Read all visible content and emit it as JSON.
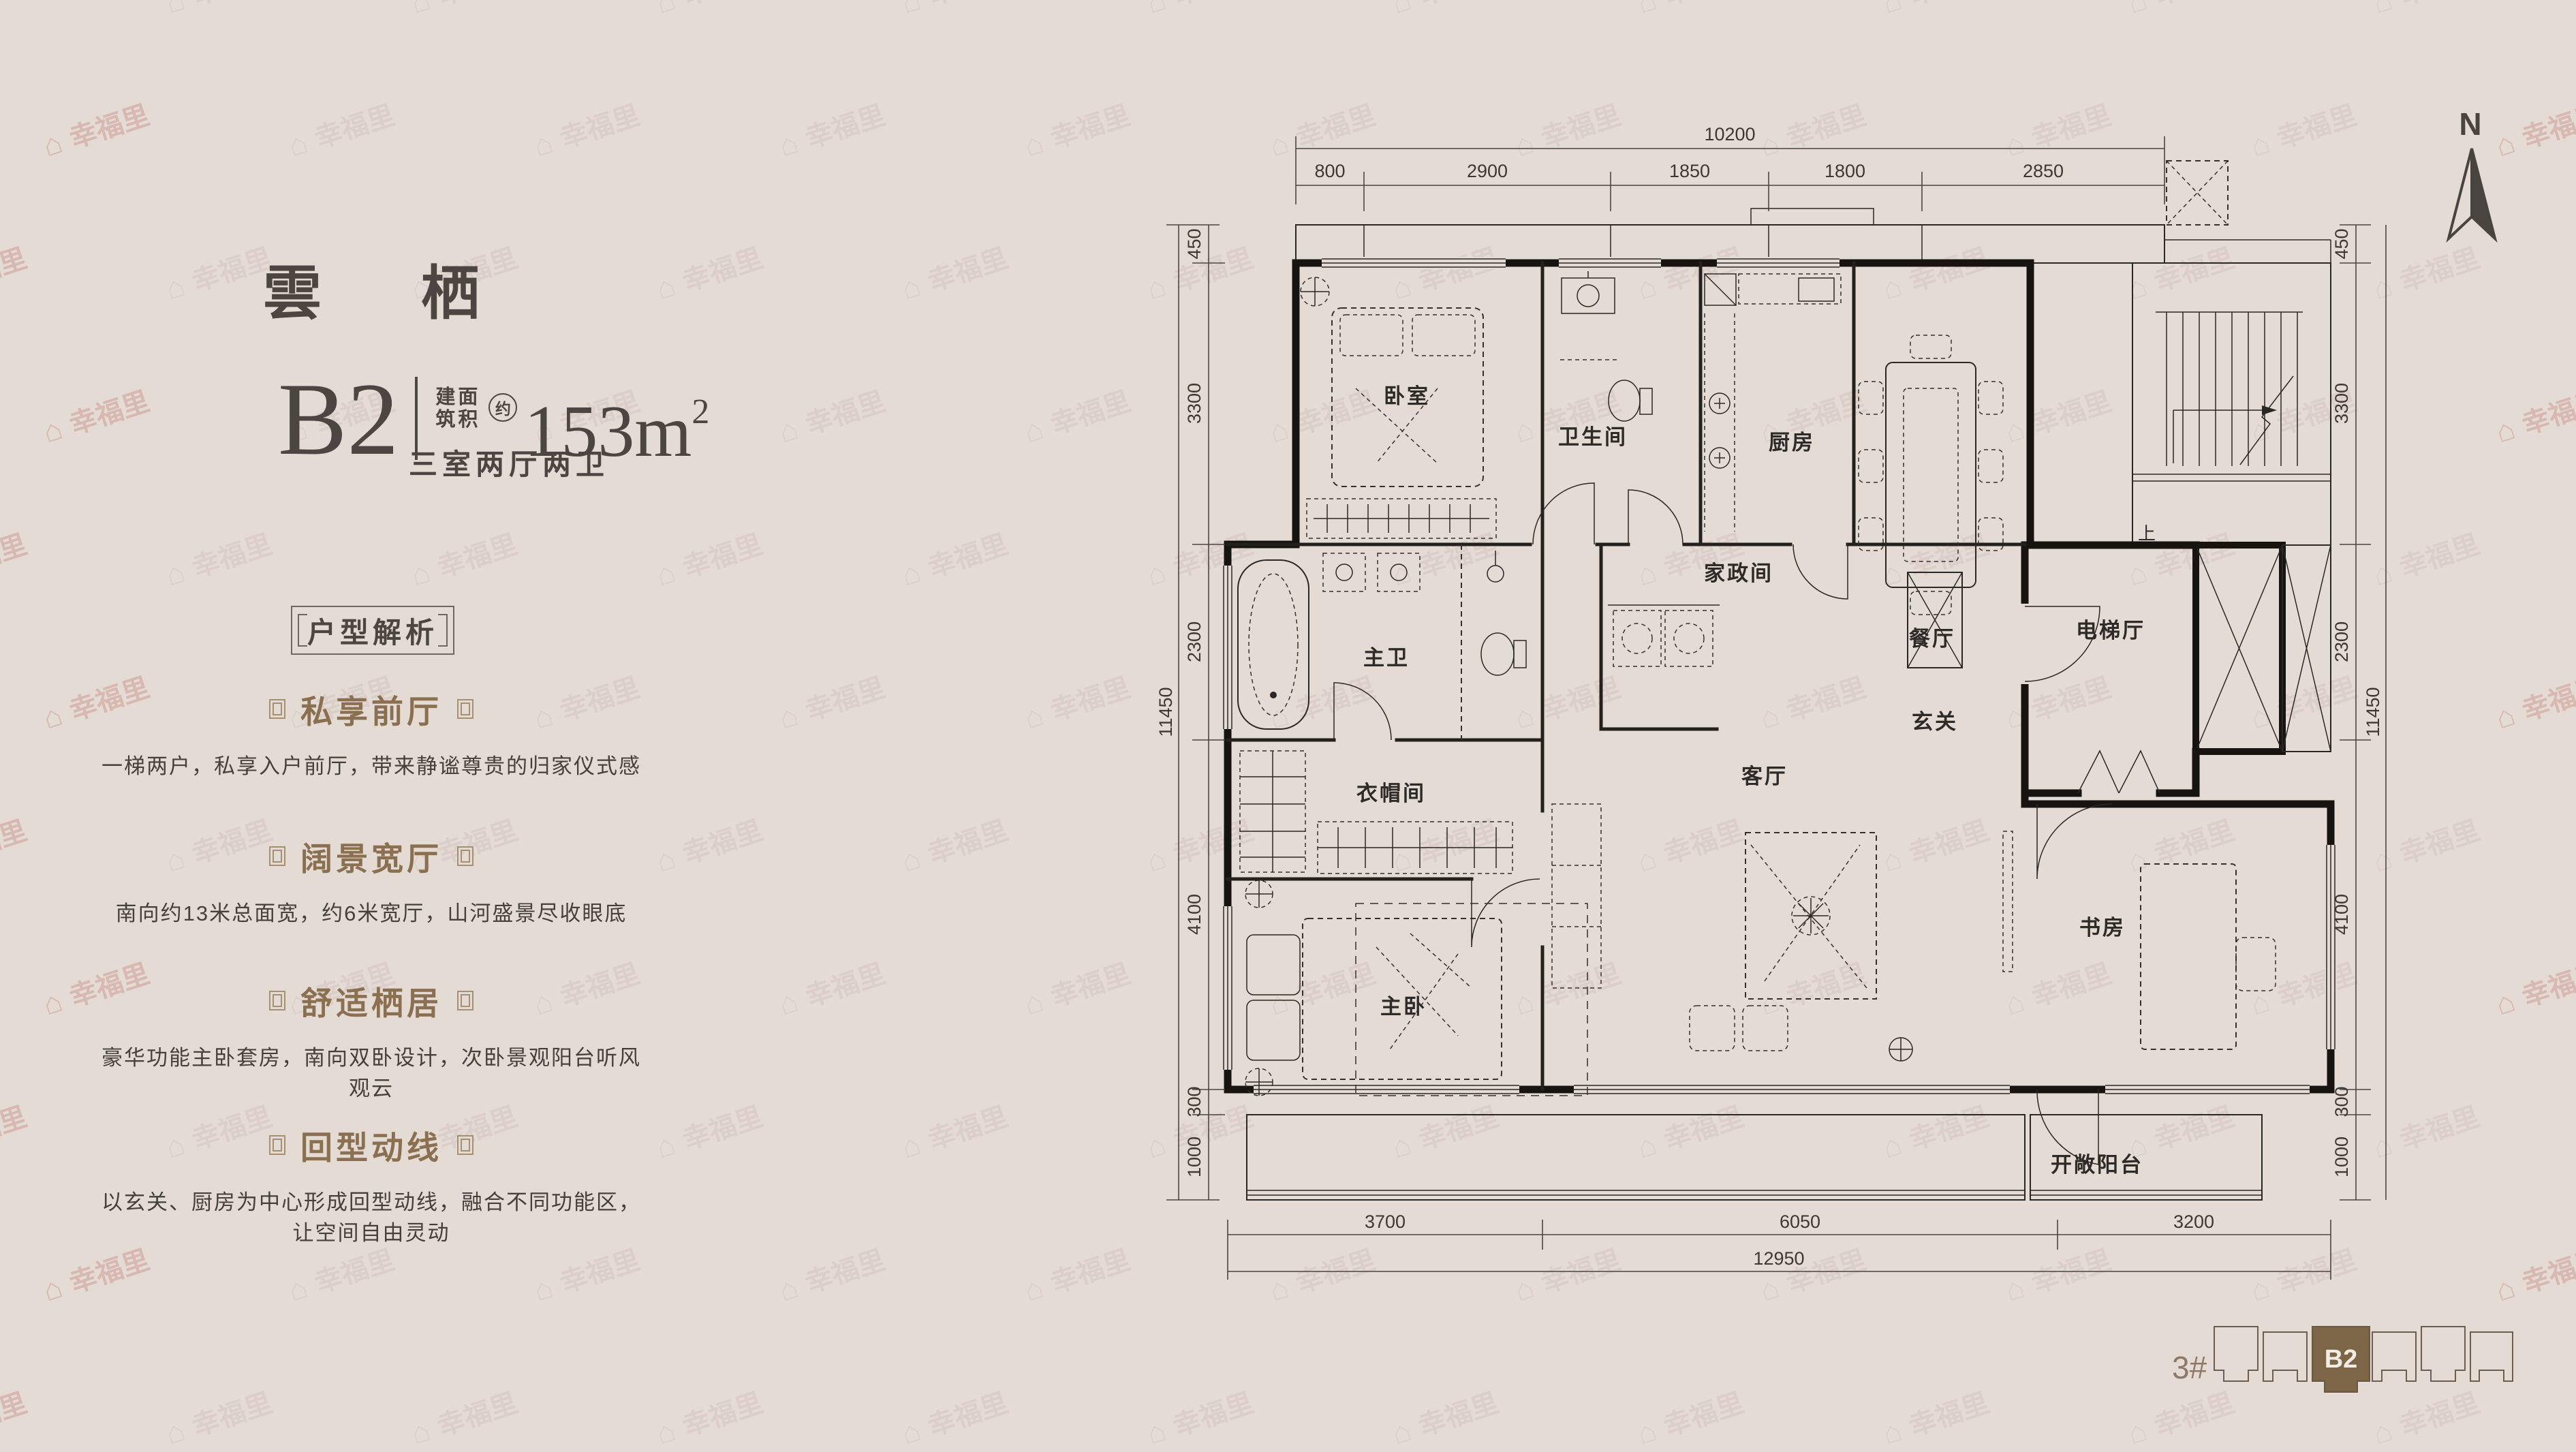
{
  "watermark": {
    "text": "幸福里",
    "icon": "house-icon"
  },
  "left_panel": {
    "title": "雲 栖",
    "unit": {
      "code": "B2",
      "area_label_line1": "建面",
      "area_label_line2": "筑积",
      "approx": "约",
      "area_value": "153m",
      "area_sup": "2",
      "layout_text": "三室两厅两卫"
    },
    "analysis_title": "户型解析",
    "sections": [
      {
        "heading": "私享前厅",
        "body": "一梯两户，私享入户前厅，带来静谧尊贵的归家仪式感"
      },
      {
        "heading": "阔景宽厅",
        "body": "南向约13米总面宽，约6米宽厅，山河盛景尽收眼底"
      },
      {
        "heading": "舒适栖居",
        "body": "豪华功能主卧套房，南向双卧设计，次卧景观阳台听风观云"
      },
      {
        "heading": "回型动线",
        "body": "以玄关、厨房为中心形成回型动线，融合不同功能区，让空间自由灵动"
      }
    ]
  },
  "floor_plan": {
    "rooms": {
      "bedroom": "卧室",
      "bathroom": "卫生间",
      "kitchen": "厨房",
      "dining": "餐厅",
      "utility": "家政间",
      "foyer": "玄关",
      "elevator_hall": "电梯厅",
      "master_bath": "主卫",
      "cloakroom": "衣帽间",
      "master_bedroom": "主卧",
      "living": "客厅",
      "study": "书房",
      "open_balcony": "开敞阳台"
    },
    "stairs_up": "上",
    "north": "N",
    "dims": {
      "top_total": "10200",
      "top_segments": [
        "800",
        "2900",
        "1850",
        "1800",
        "2850"
      ],
      "left_total": "11450",
      "left_segments": [
        "450",
        "3300",
        "2300",
        "4100",
        "300",
        "1000"
      ],
      "right_total": "11450",
      "right_segments": [
        "450",
        "3300",
        "2300",
        "4100",
        "300",
        "1000"
      ],
      "bottom_total": "12950",
      "bottom_segments": [
        "3700",
        "6050",
        "3200"
      ]
    }
  },
  "key_plan": {
    "building": "3#",
    "unit": "B2",
    "unit_color": "#7d6547"
  }
}
